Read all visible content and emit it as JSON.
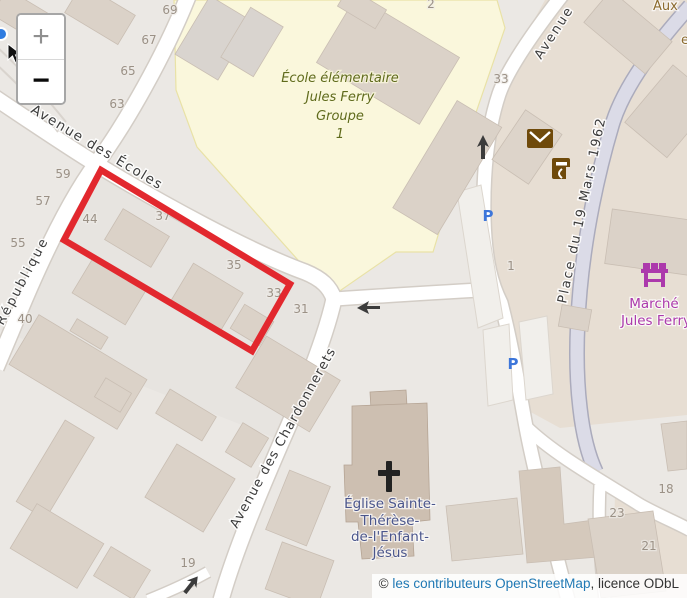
{
  "controls": {
    "zoom_in": "+",
    "zoom_out": "−"
  },
  "attribution": {
    "copyright": "© ",
    "link_text": "les contributeurs OpenStreetMap",
    "suffix": ", licence ODbL"
  },
  "map": {
    "streets": {
      "ecoles": "Avenue des Écoles",
      "republique": "République",
      "chardonnerets": "Avenue des Chardonnerets",
      "place_19_mars": "Place du 19 Mars 1962",
      "avenue_top_right": "Avenue",
      "aux_partial": "Aux",
      "e_partial": "e"
    },
    "pois": {
      "school": {
        "lines": [
          "École élémentaire",
          "Jules Ferry",
          "Groupe",
          "1"
        ]
      },
      "church": {
        "lines": [
          "Église Sainte-",
          "Thérèse-",
          "de-l'Enfant-",
          "Jésus"
        ]
      },
      "market": {
        "lines": [
          "Marché",
          "Jules Ferry"
        ]
      }
    },
    "parking_letter": "P",
    "house_numbers": [
      {
        "t": "69"
      },
      {
        "t": "67"
      },
      {
        "t": "65"
      },
      {
        "t": "63"
      },
      {
        "t": "59"
      },
      {
        "t": "57"
      },
      {
        "t": "55"
      },
      {
        "t": "44"
      },
      {
        "t": "37"
      },
      {
        "t": "35"
      },
      {
        "t": "33"
      },
      {
        "t": "31"
      },
      {
        "t": "40"
      },
      {
        "t": "19"
      },
      {
        "t": "33"
      },
      {
        "t": "1"
      },
      {
        "t": "2"
      },
      {
        "t": "18"
      },
      {
        "t": "23"
      },
      {
        "t": "21"
      }
    ],
    "colors": {
      "highlight_red": "#E2282E",
      "school_area": "#FAF7DC",
      "building": "#DBD2C8",
      "road": "#FFFFFF",
      "pedestrian_road": "#DBDBE7",
      "market_label": "#AC39AC",
      "church_label": "#4B568C",
      "school_label": "#5F6A1C",
      "parking_blue": "#3D76DA",
      "poi_brown": "#6F4A0B"
    }
  }
}
